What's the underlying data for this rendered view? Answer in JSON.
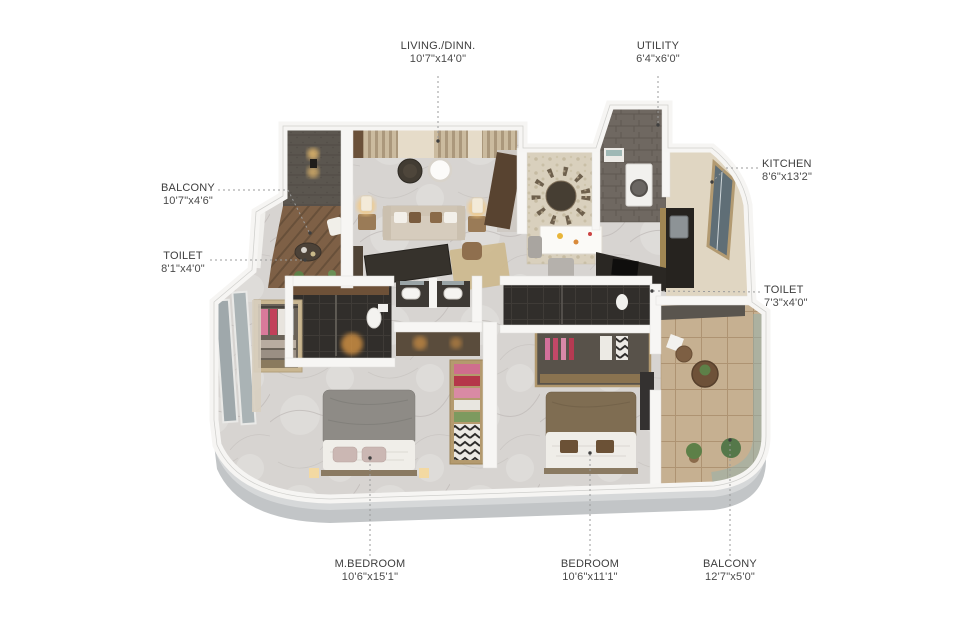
{
  "figure": {
    "kind": "3d-isometric-apartment-floor-plan",
    "background": "#ffffff",
    "label_color": "#3d3d3d"
  },
  "rooms": [
    {
      "name": "LIVING./DINN.",
      "dims": "10'7\"x14'0\""
    },
    {
      "name": "UTILITY",
      "dims": "6'4\"x6'0\""
    },
    {
      "name": "KITCHEN",
      "dims": "8'6\"x13'2\""
    },
    {
      "name": "BALCONY",
      "dims": "10'7\"x4'6\""
    },
    {
      "name": "TOILET",
      "dims": "8'1\"x4'0\""
    },
    {
      "name": "TOILET",
      "dims": "7'3\"x4'0\""
    },
    {
      "name": "M.BEDROOM",
      "dims": "10'6\"x15'1\""
    },
    {
      "name": "BEDROOM",
      "dims": "10'6\"x11'1\""
    },
    {
      "name": "BALCONY",
      "dims": "12'7\"x5'0\""
    }
  ],
  "colors": {
    "marble_floor": "#d7d4d1",
    "wood_deck": "#7e6046",
    "dark_accent_wall": "#5b564f",
    "slat_wall": "#cbbb9f",
    "balcony_tile": "#c6b091",
    "dark_toilet_tile": "#312e2b",
    "exterior_skirt": "#c2c5c7",
    "glass_railing": "#91b2b0",
    "sofa": "#d6ccbd",
    "bed_duvet_gray": "#8e8b86",
    "bed_duvet_brown": "#7f6d52"
  }
}
